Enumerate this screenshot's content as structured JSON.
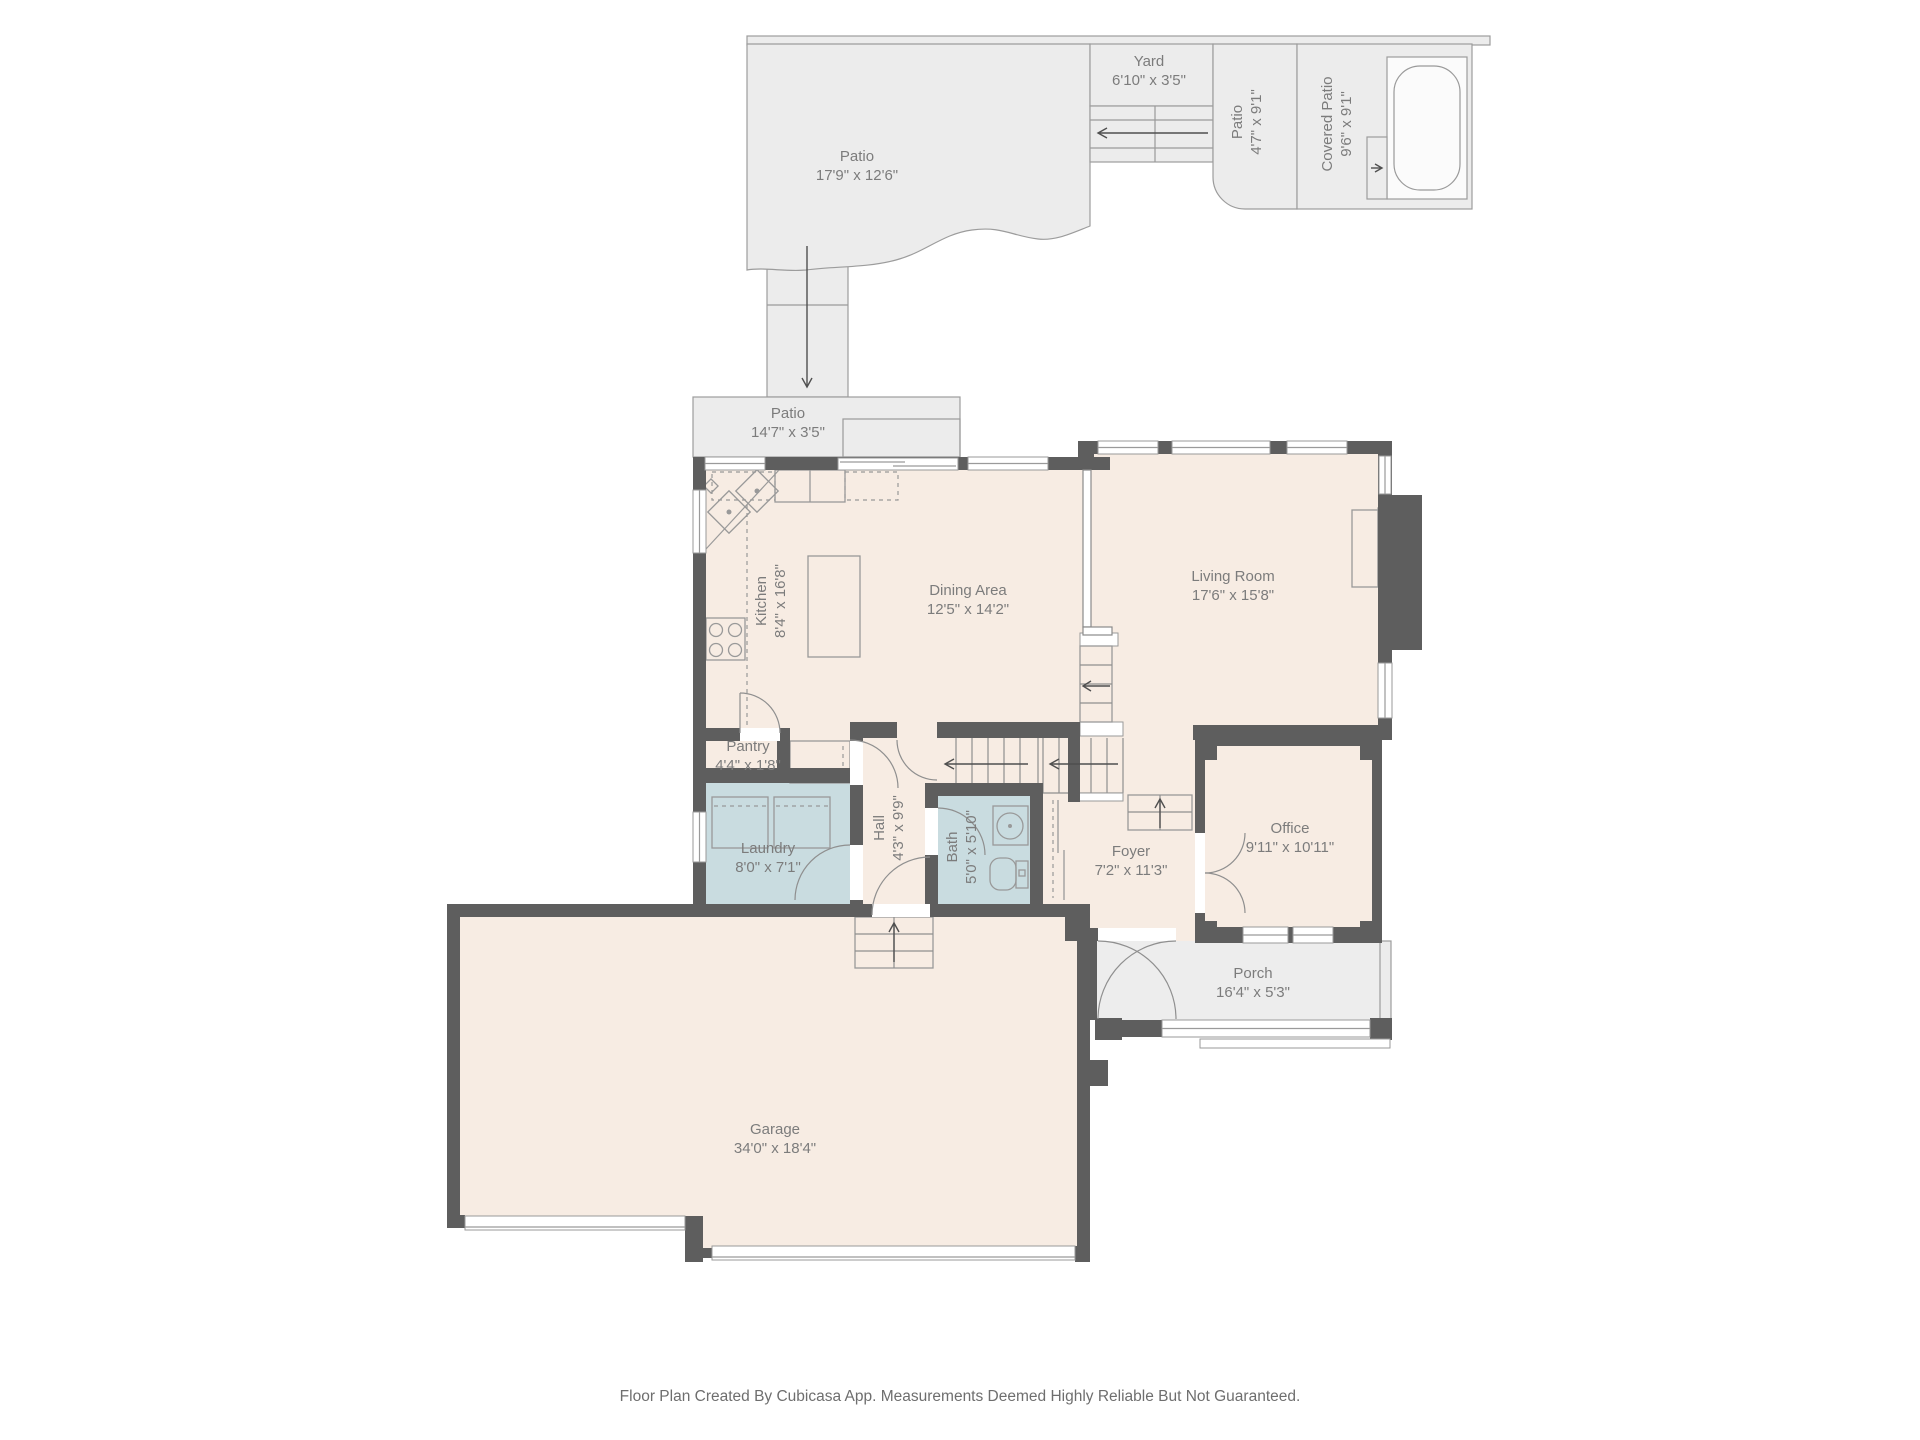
{
  "page": {
    "footer": "Floor Plan Created By Cubicasa App. Measurements Deemed Highly Reliable But Not Guaranteed."
  },
  "colors": {
    "wall": "#5e5e5e",
    "floor": "#f7ece3",
    "wet_room": "#c9dce0",
    "outdoor": "#ececec",
    "porch": "#ededed",
    "outline": "#9a9a9a",
    "label_text": "#7c7c7c"
  },
  "rooms": {
    "patio_top": {
      "name": "Patio",
      "dims": "17'9\" x 12'6\""
    },
    "yard": {
      "name": "Yard",
      "dims": "6'10\" x 3'5\""
    },
    "patio_side": {
      "name": "Patio",
      "dims": "4'7\" x 9'1\""
    },
    "covered_patio": {
      "name": "Covered Patio",
      "dims": "9'6\" x 9'1\""
    },
    "patio_mid": {
      "name": "Patio",
      "dims": "14'7\" x 3'5\""
    },
    "kitchen": {
      "name": "Kitchen",
      "dims": "8'4\" x 16'8\""
    },
    "dining": {
      "name": "Dining Area",
      "dims": "12'5\" x 14'2\""
    },
    "living": {
      "name": "Living Room",
      "dims": "17'6\" x 15'8\""
    },
    "pantry": {
      "name": "Pantry",
      "dims": "4'4\" x 1'8\""
    },
    "laundry": {
      "name": "Laundry",
      "dims": "8'0\" x 7'1\""
    },
    "hall": {
      "name": "Hall",
      "dims": "4'3\" x 9'9\""
    },
    "bath": {
      "name": "Bath",
      "dims": "5'0\" x 5'10\""
    },
    "foyer": {
      "name": "Foyer",
      "dims": "7'2\" x 11'3\""
    },
    "office": {
      "name": "Office",
      "dims": "9'11\" x 10'11\""
    },
    "porch": {
      "name": "Porch",
      "dims": "16'4\" x 5'3\""
    },
    "garage": {
      "name": "Garage",
      "dims": "34'0\" x 18'4\""
    }
  }
}
